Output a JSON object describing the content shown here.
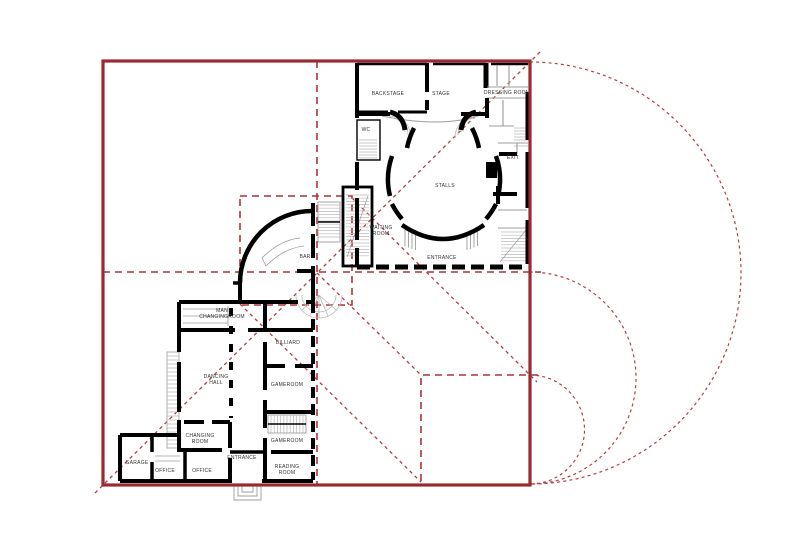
{
  "figure": {
    "type": "floor-plan-proportion-study",
    "description": "Ground floor plan with red geometric proportion overlay"
  },
  "colors": {
    "red_solid": "#9b2a2e",
    "red_dash": "#a93439",
    "red_dot": "#b23f44",
    "walls": "#000000",
    "labels": "#333333"
  },
  "rooms": [
    {
      "id": "backstage",
      "lines": [
        "BACKSTAGE"
      ],
      "x": 388,
      "y": 95
    },
    {
      "id": "stage",
      "lines": [
        "STAGE"
      ],
      "x": 441,
      "y": 95
    },
    {
      "id": "dressing-room",
      "lines": [
        "DRESSING ROOM"
      ],
      "x": 507,
      "y": 94
    },
    {
      "id": "wc",
      "lines": [
        "WC"
      ],
      "x": 366,
      "y": 131
    },
    {
      "id": "exit",
      "lines": [
        "EXIT"
      ],
      "x": 513,
      "y": 159
    },
    {
      "id": "stalls",
      "lines": [
        "STALLS"
      ],
      "x": 445,
      "y": 187
    },
    {
      "id": "waiting-room",
      "lines": [
        "WAITING",
        "ROOM"
      ],
      "x": 381,
      "y": 229
    },
    {
      "id": "theater-entrance",
      "lines": [
        "ENTRANCE"
      ],
      "x": 442,
      "y": 259
    },
    {
      "id": "bar",
      "lines": [
        "BAR"
      ],
      "x": 305,
      "y": 258
    },
    {
      "id": "man-changingroom",
      "lines": [
        "MAN",
        "CHANGINGROOM"
      ],
      "x": 222,
      "y": 312
    },
    {
      "id": "billiard",
      "lines": [
        "BILLIARD"
      ],
      "x": 288,
      "y": 344
    },
    {
      "id": "dancing-hall",
      "lines": [
        "DANCING",
        "HALL"
      ],
      "x": 216,
      "y": 378
    },
    {
      "id": "gameroom-1",
      "lines": [
        "GAMEROOM"
      ],
      "x": 287,
      "y": 386
    },
    {
      "id": "gameroom-2",
      "lines": [
        "GAMEROOM"
      ],
      "x": 287,
      "y": 442
    },
    {
      "id": "changing-room",
      "lines": [
        "CHANGING",
        "ROOM"
      ],
      "x": 200,
      "y": 437
    },
    {
      "id": "entrance",
      "lines": [
        "ENTRANCE"
      ],
      "x": 242,
      "y": 459
    },
    {
      "id": "office-1",
      "lines": [
        "OFFICE"
      ],
      "x": 165,
      "y": 472
    },
    {
      "id": "office-2",
      "lines": [
        "OFFICE"
      ],
      "x": 202,
      "y": 472
    },
    {
      "id": "reading-room",
      "lines": [
        "READING",
        "ROOM"
      ],
      "x": 287,
      "y": 468
    },
    {
      "id": "garage",
      "lines": [
        "GARAGE"
      ],
      "x": 137,
      "y": 464
    }
  ]
}
